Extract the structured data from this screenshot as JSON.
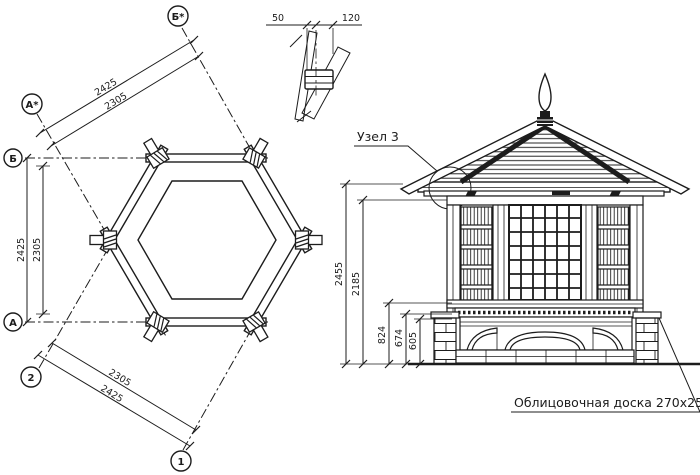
{
  "plan": {
    "axes": {
      "b_star": "Б*",
      "a_star": "А*",
      "b": "Б",
      "a": "А",
      "n2": "2",
      "n1": "1"
    },
    "dims": {
      "diag_top_outer": "2425",
      "diag_top_inner": "2305",
      "left_outer": "2425",
      "left_inner": "2305",
      "diag_bottom_inner": "2305",
      "diag_bottom_outer": "2425"
    }
  },
  "detail": {
    "dim_left": "50",
    "dim_right": "120"
  },
  "elevation": {
    "callout": "Узел 3",
    "note": "Облицовочная доска 270х25",
    "dims": {
      "total": "2455",
      "wall": "2185",
      "d824": "824",
      "d674": "674",
      "d605": "605"
    }
  },
  "colors": {
    "ink": "#1c1c1c",
    "paper": "#ffffff"
  }
}
